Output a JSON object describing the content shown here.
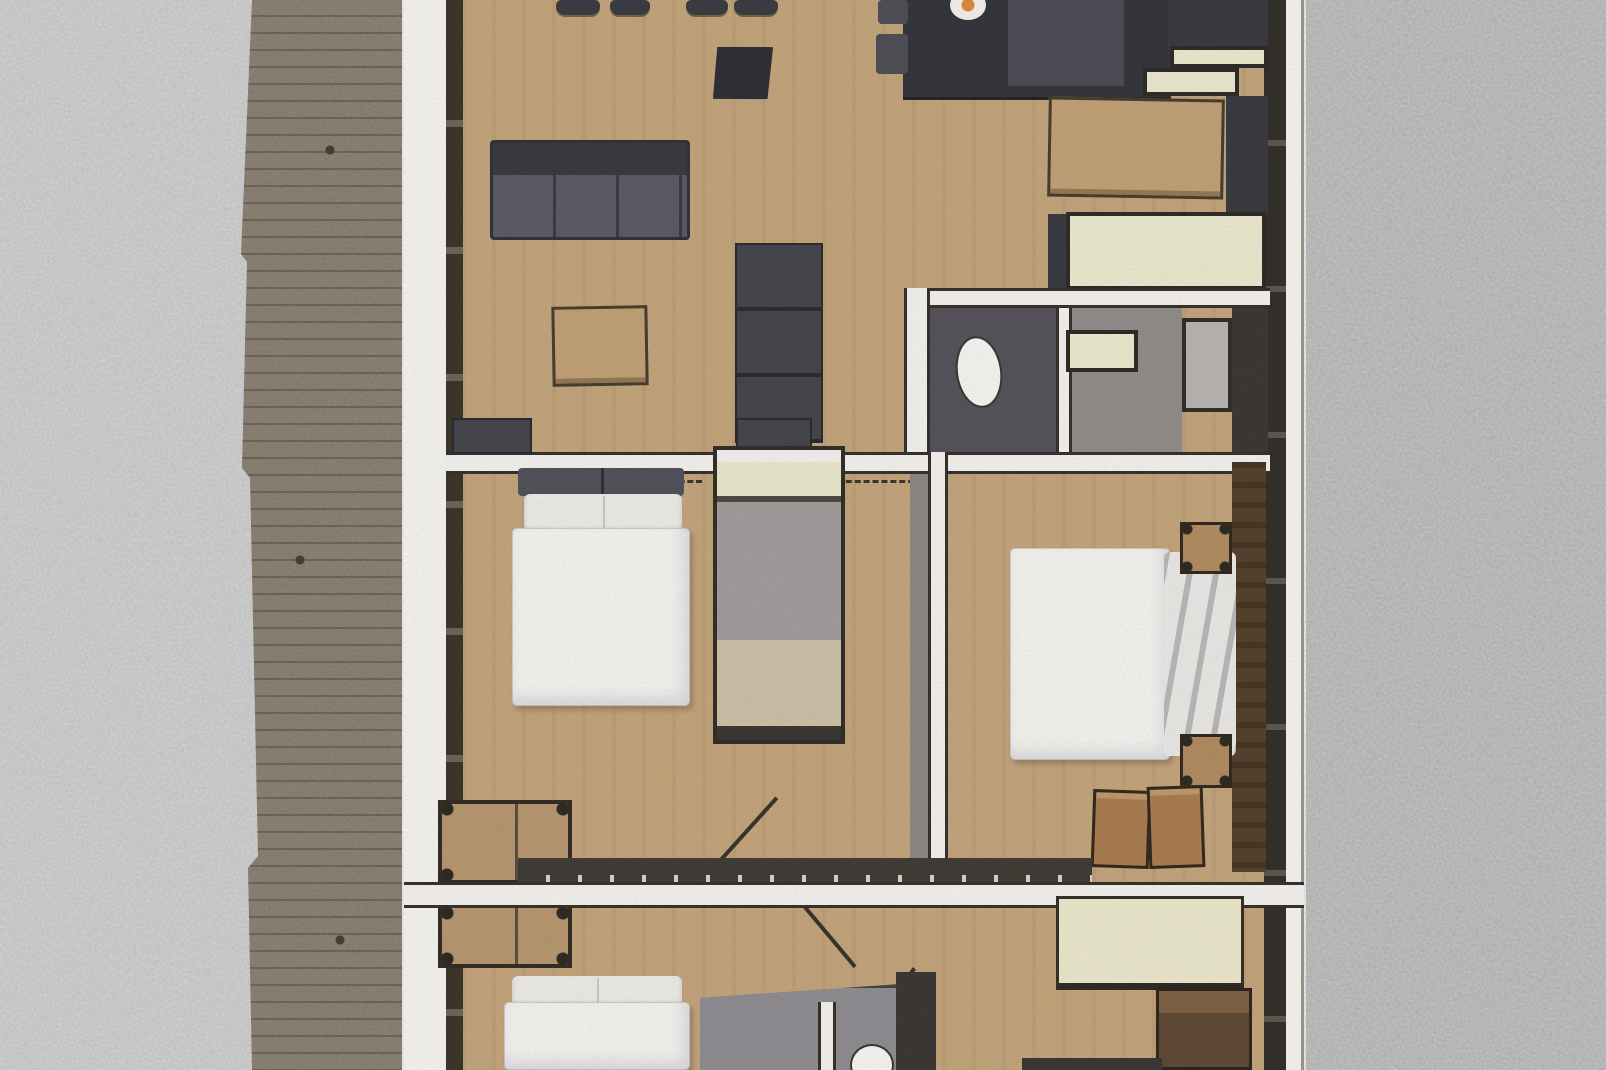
{
  "scene": {
    "type": "hand-rendered architectural floor plan sketch, top-down view",
    "orientation": "vertical apartment plan on white sheet, wooden deck walkway along left side, gray watercolor-paper background on both sides",
    "visible_text": "none"
  },
  "palette": {
    "floor_tan": "#c2a47b",
    "wall_dark": "#36312a",
    "furniture_charcoal": "#45464c",
    "counter_cream": "#e9e7cc",
    "bed_white": "#f3f2ef",
    "wood_brown_feature": "#55412d",
    "deck_wood": "#8e8477",
    "paper_sheet": "#f3f2ee",
    "background_gray_left": "#d3d3d4",
    "background_gray_right": "#c5c5c7",
    "cooktop_burner_accent": "#d98a3d",
    "bathroom_floor_dark": "#55525a",
    "bathroom_floor_gray": "#908c8a"
  },
  "rooms": [
    {
      "name": "living-dining-area",
      "position": "top-left of plan"
    },
    {
      "name": "kitchen",
      "position": "top-right of plan"
    },
    {
      "name": "bedroom-1",
      "position": "middle-left with double bed and closet"
    },
    {
      "name": "ensuite-bathroom",
      "position": "middle-right with toilet, vanity, shower"
    },
    {
      "name": "bedroom-2",
      "position": "right with double bed and brown feature wall"
    },
    {
      "name": "bedroom-3",
      "position": "bottom-left with bed partially cut off"
    },
    {
      "name": "bathroom-2",
      "position": "bottom-center with toilet"
    },
    {
      "name": "bedroom-4",
      "position": "bottom-right with cream bed and wardrobe"
    }
  ],
  "plan": {
    "items": [
      {
        "name": "dining-chair-1",
        "kind": "chair",
        "rect": [
          556,
          0,
          44,
          15
        ]
      },
      {
        "name": "dining-chair-2",
        "kind": "chair",
        "rect": [
          610,
          0,
          40,
          15
        ]
      },
      {
        "name": "dining-chair-3",
        "kind": "chair",
        "rect": [
          686,
          0,
          42,
          15
        ]
      },
      {
        "name": "dining-chair-4",
        "kind": "chair",
        "rect": [
          734,
          0,
          44,
          15
        ]
      },
      {
        "name": "side-stool",
        "kind": "stooltrap",
        "rect": [
          712,
          46,
          62,
          54
        ],
        "rot": -2
      },
      {
        "name": "sofa",
        "kind": "sofa",
        "rect": [
          490,
          140,
          200,
          100
        ]
      },
      {
        "name": "coffee-table",
        "kind": "tablewood",
        "rect": [
          552,
          306,
          96,
          80
        ],
        "rot": -1
      },
      {
        "name": "bookshelf-unit",
        "kind": "cabinet",
        "rect": [
          735,
          243,
          88,
          200
        ]
      },
      {
        "name": "kitchen-island",
        "kind": "island",
        "rect": [
          903,
          0,
          268,
          100
        ]
      },
      {
        "name": "bar-stool-1",
        "kind": "stools",
        "rect": [
          878,
          0,
          30,
          24
        ]
      },
      {
        "name": "bar-stool-2",
        "kind": "stools",
        "rect": [
          876,
          34,
          32,
          40
        ]
      },
      {
        "name": "kitchen-tall-unit",
        "kind": "darkunit",
        "rect": [
          1168,
          0,
          100,
          50
        ]
      },
      {
        "name": "kitchen-counter-1",
        "kind": "cream",
        "rect": [
          1170,
          46,
          98,
          22
        ]
      },
      {
        "name": "kitchen-counter-2",
        "kind": "cream",
        "rect": [
          1143,
          68,
          96,
          28
        ]
      },
      {
        "name": "dining-table",
        "kind": "tablewood",
        "rect": [
          1048,
          98,
          176,
          100
        ],
        "rot": 1
      },
      {
        "name": "pantry-unit",
        "kind": "darkunit",
        "rect": [
          1226,
          96,
          42,
          118
        ]
      },
      {
        "name": "counter-edge-dark",
        "kind": "darkunit",
        "rect": [
          1048,
          214,
          18,
          76
        ]
      },
      {
        "name": "kitchen-counter-big",
        "kind": "cream",
        "rect": [
          1066,
          212,
          200,
          78
        ]
      },
      {
        "name": "bathroom-floor-dark",
        "kind": "bathdark",
        "rect": [
          930,
          306,
          126,
          158
        ]
      },
      {
        "name": "bathroom-divider-wall",
        "kind": "wallv",
        "rect": [
          1056,
          306,
          16,
          158
        ]
      },
      {
        "name": "bathroom-floor-gray",
        "kind": "bathgray",
        "rect": [
          1072,
          306,
          110,
          158
        ]
      },
      {
        "name": "toilet-1",
        "kind": "toilet",
        "rect": [
          956,
          336,
          46,
          72
        ],
        "rot": -8
      },
      {
        "name": "vanity-sink",
        "kind": "cream",
        "rect": [
          1066,
          330,
          72,
          42
        ]
      },
      {
        "name": "shower",
        "kind": "shower",
        "rect": [
          1182,
          318,
          50,
          94
        ]
      },
      {
        "name": "bathroom-right-dark",
        "kind": "darkwall",
        "rect": [
          1232,
          306,
          36,
          160
        ]
      },
      {
        "name": "bathroom-top-wall",
        "kind": "wallh",
        "rect": [
          928,
          288,
          342,
          20
        ]
      },
      {
        "name": "bathroom-left-wall",
        "kind": "wallv",
        "rect": [
          904,
          288,
          26,
          176
        ]
      },
      {
        "name": "wall-living-bedroom1",
        "kind": "wallh",
        "rect": [
          446,
          452,
          824,
          22
        ]
      },
      {
        "name": "lintel-dash-1",
        "kind": "dash",
        "rect": [
          618,
          480,
          84,
          4
        ]
      },
      {
        "name": "lintel-dash-2",
        "kind": "dash",
        "rect": [
          828,
          480,
          104,
          4
        ]
      },
      {
        "name": "bedroom2-wall-poche",
        "kind": "graywall",
        "rect": [
          910,
          474,
          20,
          396
        ]
      },
      {
        "name": "bedroom2-left-wall",
        "kind": "wallv",
        "rect": [
          928,
          452,
          20,
          420
        ]
      },
      {
        "name": "credenza-1",
        "kind": "credenza",
        "rect": [
          452,
          418,
          80,
          36
        ]
      },
      {
        "name": "credenza-2",
        "kind": "credenza",
        "rect": [
          736,
          418,
          76,
          36
        ]
      },
      {
        "name": "bed1-headboard-cushions",
        "kind": "pillowdark",
        "rect": [
          518,
          468,
          166,
          28
        ]
      },
      {
        "name": "bed1-pillows",
        "kind": "pillowlight",
        "rect": [
          524,
          494,
          158,
          38
        ]
      },
      {
        "name": "bed1-duvet",
        "kind": "duvet",
        "rect": [
          512,
          528,
          178,
          178
        ]
      },
      {
        "name": "closet-laundry-room",
        "kind": "closet",
        "rect": [
          713,
          446,
          132,
          298
        ]
      },
      {
        "name": "wardrobe-left-upper",
        "kind": "dresser",
        "rect": [
          438,
          800,
          134,
          84
        ]
      },
      {
        "name": "wardrobe-left-lower",
        "kind": "dresser",
        "rect": [
          438,
          904,
          134,
          64
        ]
      },
      {
        "name": "door-leaf-bedroom1",
        "kind": "doorline",
        "rect": [
          744,
          786,
          4,
          92
        ],
        "rot": 42
      },
      {
        "name": "door-leaf-bedroom3",
        "kind": "doorline",
        "rect": [
          828,
          898,
          4,
          78
        ],
        "rot": -40
      },
      {
        "name": "door-leaf-bathroom2",
        "kind": "doorline",
        "rect": [
          893,
          962,
          4,
          66
        ],
        "rot": 36
      },
      {
        "name": "feature-wall-brown",
        "kind": "brownband",
        "rect": [
          1232,
          462,
          34,
          410
        ]
      },
      {
        "name": "bed2-duvet",
        "kind": "duvet",
        "rect": [
          1010,
          548,
          160,
          212
        ]
      },
      {
        "name": "bed2-pillows",
        "kind": "pillows2",
        "rect": [
          1164,
          552,
          72,
          204
        ]
      },
      {
        "name": "nightstand-1",
        "kind": "nightstand",
        "rect": [
          1180,
          522,
          52,
          52
        ]
      },
      {
        "name": "nightstand-2",
        "kind": "nightstand",
        "rect": [
          1180,
          734,
          52,
          54
        ]
      },
      {
        "name": "bench-box-1",
        "kind": "benchbox",
        "rect": [
          1092,
          790,
          58,
          78
        ],
        "rot": 2
      },
      {
        "name": "bench-box-2",
        "kind": "benchbox",
        "rect": [
          1148,
          786,
          56,
          82
        ],
        "rot": -2
      },
      {
        "name": "wall-glazed-dark",
        "kind": "wallCdark",
        "rect": [
          518,
          858,
          574,
          26
        ]
      },
      {
        "name": "wall-bedroom3",
        "kind": "wallh",
        "rect": [
          404,
          882,
          900,
          26
        ]
      },
      {
        "name": "bed3-pillows",
        "kind": "pillowlight",
        "rect": [
          512,
          976,
          170,
          30
        ]
      },
      {
        "name": "bed3-duvet",
        "kind": "duvet",
        "rect": [
          504,
          1002,
          186,
          68
        ]
      },
      {
        "name": "bathroom2-floor",
        "kind": "bbathfloor",
        "rect": [
          700,
          984,
          200,
          86
        ]
      },
      {
        "name": "bathroom2-wall-white",
        "kind": "wallv",
        "rect": [
          818,
          1002,
          18,
          68
        ]
      },
      {
        "name": "toilet-2",
        "kind": "toilet",
        "rect": [
          850,
          1044,
          44,
          42
        ]
      },
      {
        "name": "bathroom2-right-wall",
        "kind": "darkwall",
        "rect": [
          896,
          972,
          40,
          98
        ]
      },
      {
        "name": "bed4-cream",
        "kind": "creambed",
        "rect": [
          1056,
          896,
          188,
          94
        ]
      },
      {
        "name": "wardrobe-right",
        "kind": "wardrobe",
        "rect": [
          1156,
          988,
          96,
          82
        ]
      },
      {
        "name": "furniture-dark-strip",
        "kind": "darkstrip",
        "rect": [
          1022,
          1058,
          140,
          12
        ]
      }
    ]
  }
}
